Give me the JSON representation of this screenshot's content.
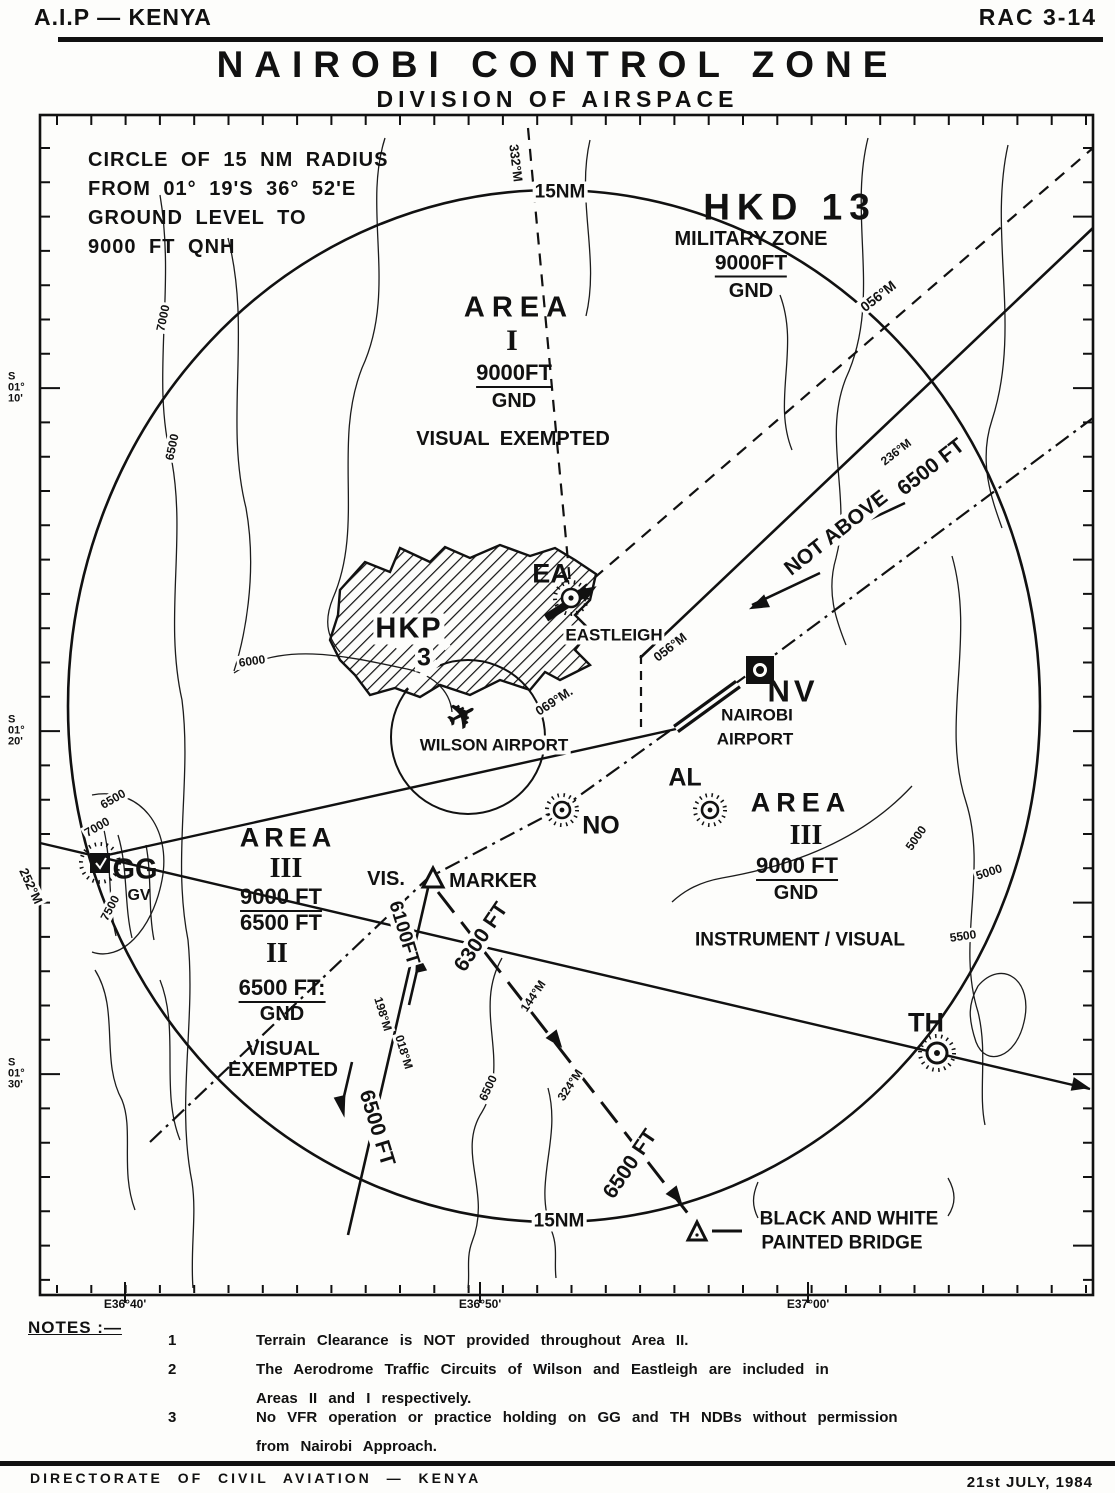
{
  "header": {
    "doc_left": "A.I.P — KENYA",
    "doc_right": "RAC 3-14",
    "title": "NAIROBI CONTROL ZONE",
    "subtitle": "DIVISION OF AIRSPACE"
  },
  "map": {
    "info_box_lines": [
      "CIRCLE OF 15 NM RADIUS",
      "FROM 01° 19'S  36° 52'E",
      "GROUND LEVEL TO",
      "9000 FT QNH"
    ],
    "labels": [
      {
        "n": "label-15nm-top",
        "t": "15NM",
        "x": 560,
        "y": 192,
        "s": 19,
        "bg": 1
      },
      {
        "n": "label-hkd13",
        "t": "HKD 13",
        "x": 790,
        "y": 207,
        "s": 37,
        "ls": 7
      },
      {
        "n": "label-military-zone",
        "t": "MILITARY ZONE",
        "x": 751,
        "y": 239,
        "s": 20
      },
      {
        "n": "label-military-upper",
        "t": "9000FT",
        "x": 751,
        "y": 265,
        "s": 21,
        "u": 1
      },
      {
        "n": "label-military-lower",
        "t": "GND",
        "x": 751,
        "y": 291,
        "s": 20
      },
      {
        "n": "label-area1-word",
        "t": "AREA",
        "x": 519,
        "y": 308,
        "s": 29,
        "ls": 7
      },
      {
        "n": "label-area1-numeral",
        "t": "I",
        "x": 512,
        "y": 341,
        "s": 30,
        "serif": 1
      },
      {
        "n": "label-area1-upper",
        "t": "9000FT",
        "x": 514,
        "y": 375,
        "s": 22,
        "u": 1
      },
      {
        "n": "label-area1-lower",
        "t": "GND",
        "x": 514,
        "y": 401,
        "s": 20
      },
      {
        "n": "label-area1-note",
        "t": "VISUAL EXEMPTED",
        "x": 513,
        "y": 439,
        "s": 20,
        "ws": 5
      },
      {
        "n": "label-bearing-332m",
        "t": "332°M",
        "x": 516,
        "y": 163,
        "s": 13,
        "r": 83,
        "bg": 1
      },
      {
        "n": "label-bearing-056m-ne",
        "t": "056°M",
        "x": 878,
        "y": 296,
        "s": 14,
        "r": -38,
        "bg": 1
      },
      {
        "n": "label-bearing-236m",
        "t": "236°M",
        "x": 896,
        "y": 452,
        "s": 12,
        "r": -38,
        "bg": 1
      },
      {
        "n": "label-corridor-altitude",
        "t": "6500 FT",
        "x": 931,
        "y": 467,
        "s": 21,
        "r": -38,
        "bg": 1
      },
      {
        "n": "label-not-above",
        "t": "NOT ABOVE",
        "x": 836,
        "y": 533,
        "s": 21,
        "r": -38,
        "bg": 1
      },
      {
        "n": "label-ndb-ea",
        "t": "EA",
        "x": 551,
        "y": 574,
        "s": 27
      },
      {
        "n": "label-eastleigh",
        "t": "EASTLEIGH",
        "x": 614,
        "y": 635,
        "s": 17,
        "bg": 1
      },
      {
        "n": "label-hkp",
        "t": "HKP",
        "x": 409,
        "y": 629,
        "s": 29,
        "ls": 2,
        "bg": 1
      },
      {
        "n": "label-hkp-3",
        "t": "3",
        "x": 424,
        "y": 658,
        "s": 25,
        "bg": 1
      },
      {
        "n": "label-bearing-056m-mid",
        "t": "056°M",
        "x": 670,
        "y": 647,
        "s": 13,
        "r": -38,
        "bg": 1
      },
      {
        "n": "label-ndb-nv",
        "t": "NV",
        "x": 793,
        "y": 691,
        "s": 31,
        "ls": 4
      },
      {
        "n": "label-nairobi-airport-1",
        "t": "NAIROBI",
        "x": 757,
        "y": 715,
        "s": 17
      },
      {
        "n": "label-nairobi-airport-2",
        "t": "AIRPORT",
        "x": 755,
        "y": 739,
        "s": 17
      },
      {
        "n": "label-bearing-069m",
        "t": "069°M.",
        "x": 554,
        "y": 701,
        "s": 13,
        "r": -33,
        "bg": 1
      },
      {
        "n": "wilson-airplane-icon",
        "t": "✈",
        "x": 462,
        "y": 716,
        "s": 36,
        "r": -28
      },
      {
        "n": "label-wilson-airport",
        "t": "WILSON AIRPORT",
        "x": 494,
        "y": 745,
        "s": 17,
        "bg": 1
      },
      {
        "n": "label-ndb-al",
        "t": "AL",
        "x": 685,
        "y": 778,
        "s": 25
      },
      {
        "n": "label-ndb-no",
        "t": "NO",
        "x": 601,
        "y": 826,
        "s": 25
      },
      {
        "n": "label-vis",
        "t": "VIS.",
        "x": 386,
        "y": 879,
        "s": 20
      },
      {
        "n": "label-marker",
        "t": "MARKER",
        "x": 493,
        "y": 881,
        "s": 20
      },
      {
        "n": "label-area3e-word",
        "t": "AREA",
        "x": 801,
        "y": 803,
        "s": 27,
        "ls": 6
      },
      {
        "n": "label-area3e-numeral",
        "t": "III",
        "x": 806,
        "y": 836,
        "s": 28,
        "serif": 1
      },
      {
        "n": "label-area3e-upper",
        "t": "9000 FT",
        "x": 797,
        "y": 868,
        "s": 22,
        "u": 1
      },
      {
        "n": "label-area3e-lower",
        "t": "GND",
        "x": 796,
        "y": 893,
        "s": 20
      },
      {
        "n": "label-instrument-visual",
        "t": "INSTRUMENT / VISUAL",
        "x": 800,
        "y": 940,
        "s": 19
      },
      {
        "n": "label-area3w-word",
        "t": "AREA",
        "x": 288,
        "y": 838,
        "s": 27,
        "ls": 5
      },
      {
        "n": "label-area3w-numeral",
        "t": "III",
        "x": 286,
        "y": 869,
        "s": 28,
        "serif": 1
      },
      {
        "n": "label-area3w-upper",
        "t": "9000 FT",
        "x": 281,
        "y": 899,
        "s": 22,
        "u": 1
      },
      {
        "n": "label-area3w-lower",
        "t": "6500 FT",
        "x": 281,
        "y": 923,
        "s": 22
      },
      {
        "n": "label-area2-numeral",
        "t": "II",
        "x": 277,
        "y": 954,
        "s": 28,
        "serif": 1
      },
      {
        "n": "label-area2-upper",
        "t": "6500 FT:",
        "x": 282,
        "y": 990,
        "s": 22,
        "u": 1
      },
      {
        "n": "label-area2-lower",
        "t": "GND",
        "x": 282,
        "y": 1014,
        "s": 20
      },
      {
        "n": "label-area2-note-1",
        "t": "VISUAL",
        "x": 283,
        "y": 1049,
        "s": 20
      },
      {
        "n": "label-area2-note-2",
        "t": "EXEMPTED",
        "x": 283,
        "y": 1070,
        "s": 20
      },
      {
        "n": "label-bearing-198m",
        "t": "198°M",
        "x": 383,
        "y": 1014,
        "s": 12,
        "r": 73,
        "bg": 1
      },
      {
        "n": "label-route-west-altitude-1",
        "t": "6100FT",
        "x": 404,
        "y": 933,
        "s": 19,
        "r": 73,
        "bg": 1
      },
      {
        "n": "label-bearing-018m",
        "t": "018°M",
        "x": 404,
        "y": 1052,
        "s": 12,
        "r": 73,
        "bg": 1
      },
      {
        "n": "label-route-west-altitude-2",
        "t": "6500 FT",
        "x": 377,
        "y": 1128,
        "s": 21,
        "r": 73,
        "bg": 1
      },
      {
        "n": "label-route-east-altitude-1",
        "t": "6300 FT",
        "x": 481,
        "y": 937,
        "s": 21,
        "r": -56,
        "bg": 1
      },
      {
        "n": "label-bearing-144m",
        "t": "144°M",
        "x": 533,
        "y": 996,
        "s": 12,
        "r": -56,
        "bg": 1
      },
      {
        "n": "label-bearing-324m",
        "t": "324°M",
        "x": 570,
        "y": 1085,
        "s": 12,
        "r": -56,
        "bg": 1
      },
      {
        "n": "label-route-east-altitude-2",
        "t": "6500 FT",
        "x": 630,
        "y": 1164,
        "s": 21,
        "r": -56,
        "bg": 1
      },
      {
        "n": "label-ndb-th",
        "t": "TH",
        "x": 926,
        "y": 1023,
        "s": 27
      },
      {
        "n": "label-ndb-gg",
        "t": "GG",
        "x": 135,
        "y": 870,
        "s": 29
      },
      {
        "n": "label-ndb-gv",
        "t": "GV",
        "x": 139,
        "y": 896,
        "s": 16
      },
      {
        "n": "label-bearing-252m",
        "t": "252°M",
        "x": 31,
        "y": 886,
        "s": 13,
        "r": 65,
        "bg": 1
      },
      {
        "n": "label-15nm-bottom",
        "t": "15NM",
        "x": 559,
        "y": 1221,
        "s": 19,
        "bg": 1
      },
      {
        "n": "label-bridge-line-1",
        "t": "BLACK AND WHITE",
        "x": 849,
        "y": 1219,
        "s": 19
      },
      {
        "n": "label-bridge-line-2",
        "t": "PAINTED BRIDGE",
        "x": 842,
        "y": 1243,
        "s": 19
      },
      {
        "n": "label-contour-7000-nw",
        "t": "7000",
        "x": 163,
        "y": 318,
        "s": 12,
        "r": -78,
        "bg": 1
      },
      {
        "n": "label-contour-6500-nw",
        "t": "6500",
        "x": 172,
        "y": 447,
        "s": 12,
        "r": -78,
        "bg": 1
      },
      {
        "n": "label-contour-6000-w",
        "t": "6000",
        "x": 252,
        "y": 661,
        "s": 12,
        "r": -8,
        "bg": 1
      },
      {
        "n": "label-contour-6500-gg",
        "t": "6500",
        "x": 113,
        "y": 799,
        "s": 12,
        "r": -30,
        "bg": 1
      },
      {
        "n": "label-contour-7000-gg",
        "t": "7000",
        "x": 97,
        "y": 827,
        "s": 12,
        "r": -30,
        "bg": 1
      },
      {
        "n": "label-contour-7500-gg",
        "t": "7500",
        "x": 110,
        "y": 908,
        "s": 12,
        "r": -62,
        "bg": 1
      },
      {
        "n": "label-contour-5000-ne",
        "t": "5000",
        "x": 916,
        "y": 838,
        "s": 12,
        "r": -55,
        "bg": 1
      },
      {
        "n": "label-contour-5000-e",
        "t": "5000",
        "x": 989,
        "y": 872,
        "s": 12,
        "r": -18,
        "bg": 1
      },
      {
        "n": "label-contour-5500-e",
        "t": "5500",
        "x": 963,
        "y": 936,
        "s": 12,
        "r": -8,
        "bg": 1
      },
      {
        "n": "label-contour-6500-s",
        "t": "6500",
        "x": 488,
        "y": 1088,
        "s": 12,
        "r": -65,
        "bg": 1
      }
    ]
  },
  "axis": {
    "lat_labels": [
      {
        "lines": [
          "S",
          "01°",
          "10'"
        ],
        "y": 388
      },
      {
        "lines": [
          "S",
          "01°",
          "20'"
        ],
        "y": 731
      },
      {
        "lines": [
          "S",
          "01°",
          "30'"
        ],
        "y": 1074
      }
    ],
    "lon_labels": [
      {
        "text": "E36°40'",
        "x": 125
      },
      {
        "text": "E36°50'",
        "x": 480
      },
      {
        "text": "E37°00'",
        "x": 808
      }
    ]
  },
  "notes": {
    "heading": "NOTES :—",
    "items": [
      {
        "num": "1",
        "lines": [
          "Terrain  Clearance  is  NOT  provided  throughout  Area II."
        ]
      },
      {
        "num": "2",
        "lines": [
          "The  Aerodrome  Traffic  Circuits  of  Wilson  and  Eastleigh  are  included  in",
          "Areas  II  and  I  respectively."
        ]
      },
      {
        "num": "3",
        "lines": [
          "No  VFR  operation  or  practice  holding  on  GG  and  TH  NDBs  without  permission",
          "from  Nairobi  Approach."
        ]
      }
    ]
  },
  "footer": {
    "left": "DIRECTORATE  OF  CIVIL  AVIATION — KENYA",
    "right": "21st JULY, 1984"
  },
  "colors": {
    "ink": "#111111",
    "paper": "#fdfdfb"
  }
}
